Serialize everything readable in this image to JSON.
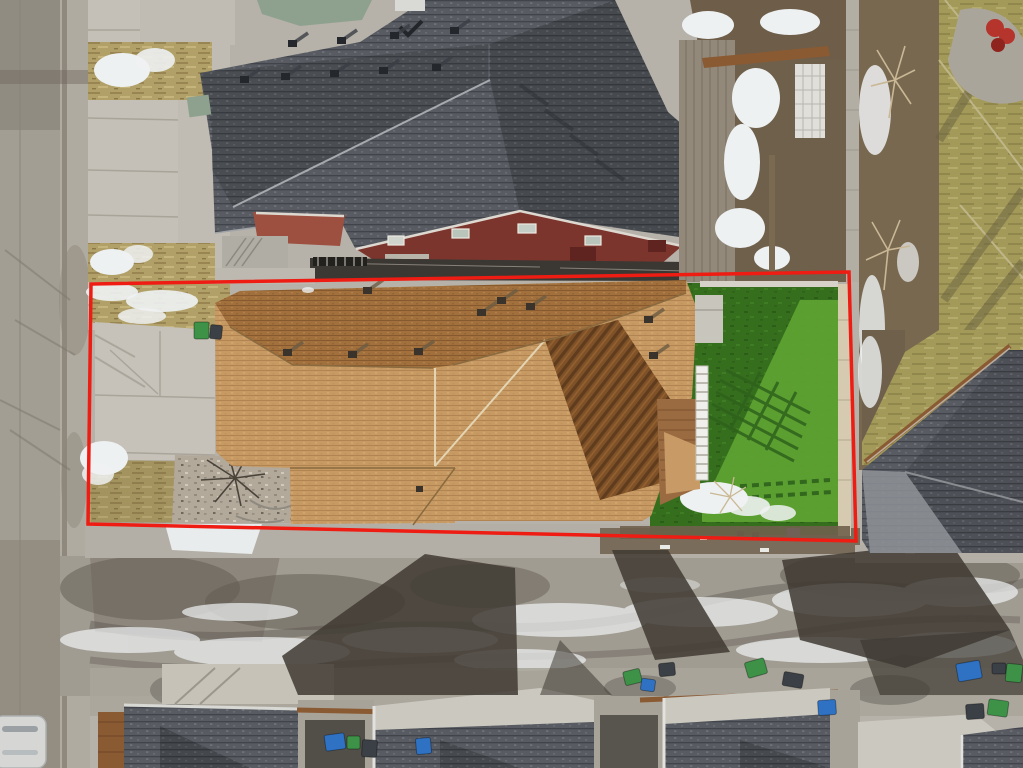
{
  "meta": {
    "type": "aerial-drone-photograph",
    "subject": "top-down view of a residential lot with tan shingle roof, artificial turf backyard, driveway, rear alley with garages and waste bins",
    "season_cues": "patches of snow on dry winter grass",
    "visible_text": ""
  },
  "annotation": {
    "kind": "property-boundary-outline",
    "shape": "quadrilateral",
    "color": "#ee1c12",
    "stroke_width": 3.5,
    "points": "91,284 849,272 856,541 88,524"
  },
  "palette": {
    "concrete": "#b6b2a9",
    "street": "#a39e94",
    "street_wet": "#8e897e",
    "sidewalk": "#c4c0b7",
    "joint": "#a5a197",
    "roof_gray_edge": "#b5b8bc",
    "sage_roof": "#8ea18f",
    "maroon_wall": "#7c352d",
    "maroon_roof": "#9d4f40",
    "trim_white": "#ded9d0",
    "roof_tan_shadowline": "#8a6a3f",
    "valley_light": "#e3d5b4",
    "turf_light": "#60a433",
    "turf_stripe": "#2e621c",
    "fence_light": "#d6cbb0",
    "fence_gray": "#b3aea3",
    "soil": "#6f604c",
    "snow": "#eef1f2",
    "alley": "#a19c92",
    "stain": "#5f594f",
    "shadow_dark": "#3f3a33",
    "wood_deck": "#9a6a40",
    "wood_brown": "#8a5a33",
    "garage_light": "#cbc8c0",
    "apron": "#aaa59b",
    "gravelc": "#b2a99b",
    "bin_green": "#3d9247",
    "bin_blue": "#2f72c4",
    "bin_dark": "#3b4046",
    "car_white": "#d6d7d5",
    "stair_white": "#f0efeb",
    "bush_red": "#b5342c",
    "olive_seam": "#c2b98e"
  },
  "objects": {
    "subject_roof": "tan asphalt shingle roof with dark upper north slope, shaded ribbed southeast facet, roof vents and valleys",
    "backyard": "green artificial turf with railing shadows, snow remnants, purple toy, wooden deck and white staircase",
    "front_yard": "concrete driveway slabs, dry grass with snow, gravel bed with bare shrub, green and dark waste bins",
    "neighbors": "dark gray shingle roofs, sage-green roof section, maroon gable wall with windows, weathered wood deck, white lattice",
    "right_side": "olive winter lawns, bare trees, curved concrete pad with red shrub, diagonal wood fence, gray hip roof",
    "alley": "wet stained concrete lane with ice streaks, long building shadows, garage roofs, parked white car",
    "bins": [
      {
        "x": 194,
        "y": 322,
        "w": 15,
        "h": 17,
        "c": "bin_green",
        "r": 0
      },
      {
        "x": 210,
        "y": 325,
        "w": 12,
        "h": 14,
        "c": "bin_dark",
        "r": 6
      },
      {
        "x": 325,
        "y": 734,
        "w": 20,
        "h": 16,
        "c": "bin_blue",
        "r": -8
      },
      {
        "x": 347,
        "y": 736,
        "w": 13,
        "h": 13,
        "c": "bin_green",
        "r": 0
      },
      {
        "x": 362,
        "y": 740,
        "w": 15,
        "h": 17,
        "c": "bin_dark",
        "r": 4
      },
      {
        "x": 416,
        "y": 738,
        "w": 15,
        "h": 16,
        "c": "bin_blue",
        "r": -5
      },
      {
        "x": 624,
        "y": 670,
        "w": 17,
        "h": 14,
        "c": "bin_green",
        "r": -14
      },
      {
        "x": 641,
        "y": 679,
        "w": 14,
        "h": 12,
        "c": "bin_blue",
        "r": 8
      },
      {
        "x": 659,
        "y": 663,
        "w": 16,
        "h": 13,
        "c": "bin_dark",
        "r": -6
      },
      {
        "x": 746,
        "y": 660,
        "w": 20,
        "h": 16,
        "c": "bin_green",
        "r": -16
      },
      {
        "x": 783,
        "y": 673,
        "w": 20,
        "h": 14,
        "c": "bin_dark",
        "r": 10
      },
      {
        "x": 818,
        "y": 700,
        "w": 18,
        "h": 15,
        "c": "bin_blue",
        "r": -4
      },
      {
        "x": 957,
        "y": 662,
        "w": 24,
        "h": 18,
        "c": "bin_blue",
        "r": -10
      },
      {
        "x": 992,
        "y": 663,
        "w": 14,
        "h": 11,
        "c": "bin_dark",
        "r": 0
      },
      {
        "x": 1006,
        "y": 664,
        "w": 16,
        "h": 18,
        "c": "bin_green",
        "r": 6
      },
      {
        "x": 966,
        "y": 704,
        "w": 18,
        "h": 15,
        "c": "bin_dark",
        "r": -4
      },
      {
        "x": 988,
        "y": 700,
        "w": 20,
        "h": 16,
        "c": "bin_green",
        "r": 8
      }
    ],
    "subject_roof_vents": [
      [
        283,
        349
      ],
      [
        348,
        351
      ],
      [
        414,
        348
      ],
      [
        477,
        309
      ],
      [
        526,
        303
      ],
      [
        363,
        287
      ],
      [
        497,
        297
      ],
      [
        644,
        316
      ],
      [
        649,
        352
      ]
    ],
    "neighbor_roof_vents": [
      [
        240,
        76
      ],
      [
        281,
        73
      ],
      [
        330,
        70
      ],
      [
        379,
        67
      ],
      [
        432,
        64
      ],
      [
        288,
        40
      ],
      [
        337,
        37
      ],
      [
        390,
        32
      ],
      [
        450,
        27
      ]
    ]
  }
}
